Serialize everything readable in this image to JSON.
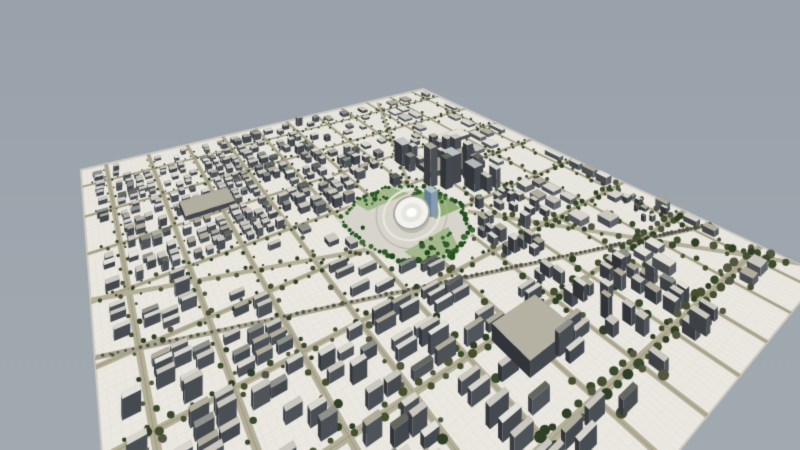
{
  "scene": {
    "canvas": {
      "width": 800,
      "height": 450
    },
    "background": {
      "top": "#99a2ab",
      "bottom": "#a2aab1"
    },
    "plane": {
      "corners": [
        [
          81,
          170
        ],
        [
          423,
          89
        ],
        [
          822,
          275
        ],
        [
          150,
          1100
        ]
      ],
      "fill": "#eae8e1",
      "edge": "#cfccc4",
      "grid": {
        "step": 0.01,
        "major": 0.05,
        "minorAlpha": 0.035,
        "majorAlpha": 0.055,
        "color": "138,138,126"
      }
    },
    "roads": {
      "fill": "#b4af98",
      "centerline": "rgba(110,108,86,0.35)",
      "halfWidth": 0.0045,
      "treeColors": [
        "#46502f",
        "#3a4a2c",
        "#515741",
        "#2f4026"
      ],
      "u": [
        0.05,
        0.14,
        0.23,
        0.32,
        0.41,
        0.5,
        0.59,
        0.68,
        0.77,
        0.86,
        0.95
      ],
      "v": [
        0.08,
        0.2,
        0.32,
        0.44,
        0.56,
        0.68,
        0.8,
        0.92
      ],
      "diagonals": [
        {
          "a": [
            0.635,
            0.575
          ],
          "b": [
            1.02,
            0.99
          ],
          "w": 0.006,
          "rail": false
        },
        {
          "a": [
            0.0,
            0.435
          ],
          "b": [
            0.42,
            0.565
          ],
          "w": 0.005,
          "rail": false
        },
        {
          "a": [
            0.0,
            0.545
          ],
          "b": [
            1.0,
            0.85
          ],
          "w": 0.004,
          "rail": true
        },
        {
          "a": [
            0.6,
            0.43
          ],
          "b": [
            0.8,
            0.02
          ],
          "w": 0.004,
          "rail": false
        }
      ],
      "railBed": "#a5a28e",
      "railTie": "#545246"
    },
    "park": {
      "polygon": [
        [
          0.405,
          0.46
        ],
        [
          0.47,
          0.425
        ],
        [
          0.555,
          0.42
        ],
        [
          0.625,
          0.465
        ],
        [
          0.645,
          0.55
        ],
        [
          0.6,
          0.625
        ],
        [
          0.515,
          0.66
        ],
        [
          0.44,
          0.625
        ],
        [
          0.402,
          0.545
        ]
      ],
      "base": "#d7d5cb",
      "lawnColors": [
        "#a3b98a",
        "#8fae74"
      ],
      "lawns": [
        [
          [
            0.46,
            0.43
          ],
          [
            0.555,
            0.425
          ],
          [
            0.575,
            0.465
          ],
          [
            0.47,
            0.47
          ]
        ],
        [
          [
            0.575,
            0.47
          ],
          [
            0.635,
            0.48
          ],
          [
            0.63,
            0.56
          ],
          [
            0.565,
            0.56
          ]
        ],
        [
          [
            0.46,
            0.6
          ],
          [
            0.57,
            0.59
          ],
          [
            0.545,
            0.645
          ],
          [
            0.465,
            0.635
          ]
        ]
      ],
      "path": "#e9e7e0",
      "treeColors": [
        "#1f4a20",
        "#2f5c2a",
        "#3f6b33",
        "#27521f"
      ],
      "clumps": [
        {
          "c": [
            0.6,
            0.5
          ],
          "r": 0.035,
          "n": 30
        },
        {
          "c": [
            0.5,
            0.445
          ],
          "r": 0.03,
          "n": 16
        },
        {
          "c": [
            0.505,
            0.625
          ],
          "r": 0.032,
          "n": 15
        }
      ],
      "scatter": 18,
      "stadium": {
        "c": [
          0.535,
          0.525
        ],
        "ru": 0.038,
        "rv": 0.035,
        "outer": "#f3f2ee",
        "ring": "#a8a7a0",
        "inner": "#e6e5de",
        "shadow": "rgba(150,150,140,0.45)"
      }
    },
    "districts": [
      {
        "name": "towers-east",
        "u": [
          0.6,
          0.78
        ],
        "v": [
          0.32,
          0.62
        ],
        "cell": [
          0.03,
          0.03
        ],
        "density": 0.42,
        "h": [
          0.03,
          0.085
        ],
        "tall": true,
        "slab": false,
        "light": false
      },
      {
        "name": "warehouses-ne",
        "u": [
          0.74,
          1.0
        ],
        "v": [
          0.02,
          0.6
        ],
        "cell": [
          0.04,
          0.055
        ],
        "density": 0.4,
        "h": [
          0.008,
          0.016
        ],
        "tall": false,
        "slab": false,
        "light": true
      },
      {
        "name": "warehouses-se",
        "u": [
          0.74,
          1.0
        ],
        "v": [
          0.6,
          0.97
        ],
        "cell": [
          0.034,
          0.04
        ],
        "density": 0.52,
        "h": [
          0.008,
          0.018
        ],
        "tall": false,
        "slab": false,
        "light": true
      },
      {
        "name": "center-north",
        "u": [
          0.3,
          0.6
        ],
        "v": [
          0.02,
          0.4
        ],
        "cell": [
          0.024,
          0.022
        ],
        "density": 0.66,
        "h": [
          0.014,
          0.045
        ],
        "tall": false,
        "slab": false,
        "light": false
      },
      {
        "name": "northwest-dense",
        "u": [
          0.0,
          0.3
        ],
        "v": [
          0.02,
          0.45
        ],
        "cell": [
          0.021,
          0.019
        ],
        "density": 0.74,
        "h": [
          0.012,
          0.032
        ],
        "tall": false,
        "slab": false,
        "light": false
      },
      {
        "name": "southwest-rows",
        "u": [
          0.0,
          0.35
        ],
        "v": [
          0.45,
          0.97
        ],
        "cell": [
          0.03,
          0.018
        ],
        "density": 0.6,
        "h": [
          0.012,
          0.034
        ],
        "tall": false,
        "slab": true,
        "light": false
      },
      {
        "name": "south-center",
        "u": [
          0.35,
          0.6
        ],
        "v": [
          0.62,
          0.97
        ],
        "cell": [
          0.042,
          0.016
        ],
        "density": 0.52,
        "h": [
          0.012,
          0.03
        ],
        "tall": false,
        "slab": true,
        "light": false
      },
      {
        "name": "east-center",
        "u": [
          0.6,
          0.74
        ],
        "v": [
          0.62,
          0.97
        ],
        "cell": [
          0.021,
          0.021
        ],
        "density": 0.56,
        "h": [
          0.012,
          0.028
        ],
        "tall": false,
        "slab": false,
        "light": false
      }
    ],
    "fallbackDistrict": {
      "cell": [
        0.03,
        0.03
      ],
      "density": 0.28,
      "h": [
        0.008,
        0.02
      ],
      "tall": false,
      "slab": false,
      "light": false
    },
    "buildingStyle": {
      "leftFace": [
        55,
        59,
        64
      ],
      "frontFace": [
        74,
        79,
        86
      ],
      "lightLift": 20,
      "tops": [
        "#cbc8c0",
        "#d8d6cf",
        "#b2ae9e",
        "#90938d",
        "#64675f",
        "#e3e2dc"
      ],
      "topWeights": [
        0.42,
        0.18,
        0.16,
        0.12,
        0.06,
        0.06
      ],
      "lightTops": [
        "#d6d4cc",
        "#cbc8c0",
        "#e0dfd8",
        "#b2ae9e"
      ]
    },
    "landmarks": [
      {
        "u0": 0.63,
        "v0": 0.34,
        "u1": 0.655,
        "v1": 0.37,
        "h": 0.065,
        "top": "#c2c6c9"
      },
      {
        "u0": 0.67,
        "v0": 0.46,
        "u1": 0.7,
        "v1": 0.49,
        "h": 0.075,
        "top": "#bdc2c5"
      },
      {
        "u0": 0.695,
        "v0": 0.505,
        "u1": 0.72,
        "v1": 0.535,
        "h": 0.058,
        "top": "#b4b8bb"
      },
      {
        "u0": 0.72,
        "v0": 0.42,
        "u1": 0.79,
        "v1": 0.475,
        "h": 0.018,
        "top": "#6e6963"
      },
      {
        "u0": 0.655,
        "v0": 0.4,
        "u1": 0.715,
        "v1": 0.445,
        "h": 0.014,
        "top": "#a9a596"
      },
      {
        "u0": 0.78,
        "v0": 0.305,
        "u1": 0.875,
        "v1": 0.345,
        "h": 0.01,
        "top": "#e2e1da"
      },
      {
        "u0": 0.16,
        "v0": 0.26,
        "u1": 0.255,
        "v1": 0.315,
        "h": 0.016,
        "top": "#b2aea0"
      },
      {
        "u0": 0.455,
        "v0": 0.8,
        "u1": 0.545,
        "v1": 0.862,
        "h": 0.02,
        "top": "#b5b1a3"
      }
    ],
    "blueTower": {
      "u0": 0.561,
      "v0": 0.532,
      "u1": 0.578,
      "v1": 0.552,
      "h": 0.055,
      "left": "#64809a",
      "front": "#849cb0",
      "top": "#b2c3cd"
    },
    "farCluster": {
      "u": [
        0.895,
        0.975
      ],
      "v": [
        0.715,
        0.785
      ],
      "boxes": 9,
      "trees": 7
    },
    "render": {
      "seed": 11,
      "heightScale": 1.0,
      "margin": 0.007,
      "treeStepU": 0.012,
      "treeStepV": 0.018
    }
  }
}
